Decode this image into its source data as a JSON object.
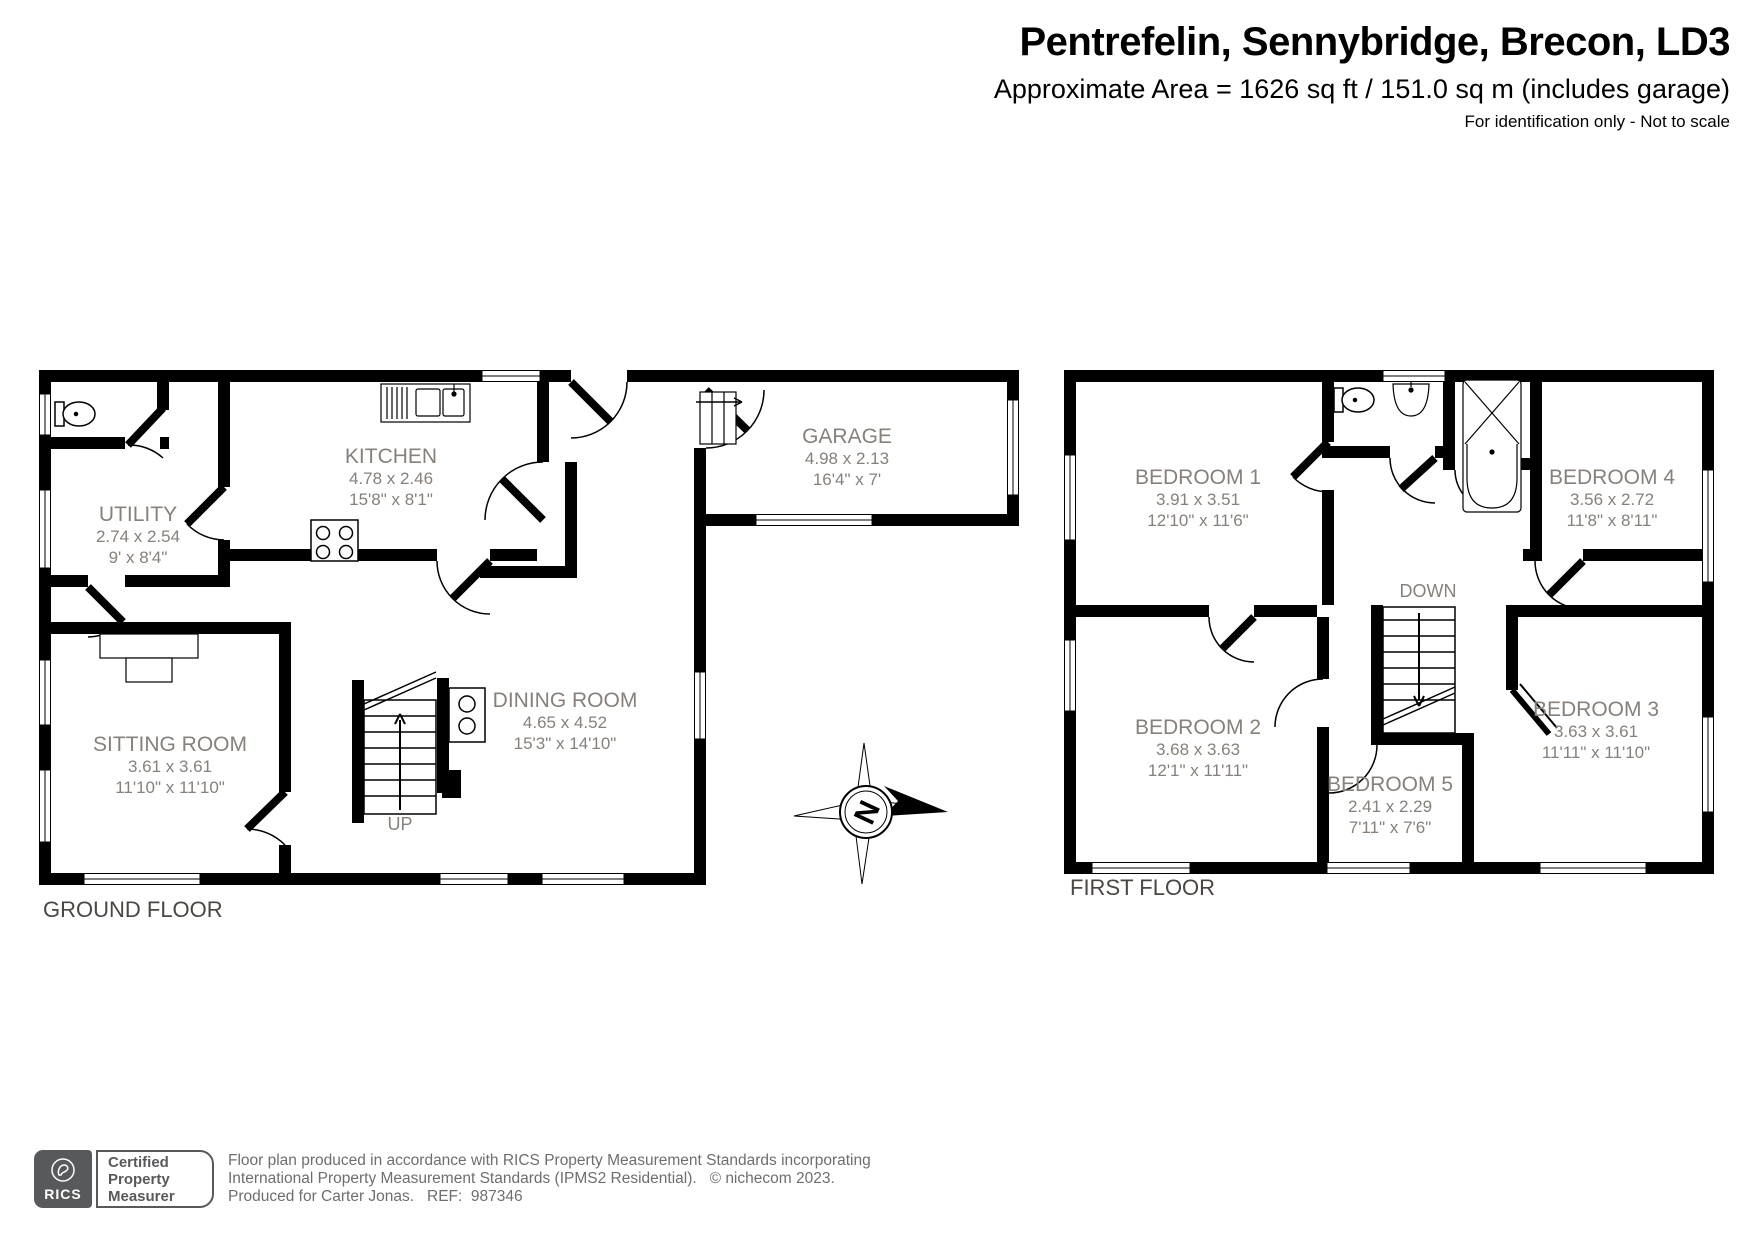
{
  "header": {
    "title": "Pentrefelin, Sennybridge, Brecon, LD3",
    "subtitle": "Approximate Area = 1626 sq ft / 151.0 sq m (includes garage)",
    "disclaimer": "For identification only - Not to scale"
  },
  "ground_floor": {
    "label": "GROUND FLOOR",
    "stair_label": "UP",
    "rooms": [
      {
        "name": "UTILITY",
        "metric": "2.74 x 2.54",
        "imperial": "9' x 8'4\""
      },
      {
        "name": "KITCHEN",
        "metric": "4.78 x 2.46",
        "imperial": "15'8\" x 8'1\""
      },
      {
        "name": "GARAGE",
        "metric": "4.98 x 2.13",
        "imperial": "16'4\" x 7'"
      },
      {
        "name": "SITTING ROOM",
        "metric": "3.61 x 3.61",
        "imperial": "11'10\" x 11'10\""
      },
      {
        "name": "DINING ROOM",
        "metric": "4.65 x 4.52",
        "imperial": "15'3\" x 14'10\""
      }
    ]
  },
  "first_floor": {
    "label": "FIRST FLOOR",
    "stair_label": "DOWN",
    "rooms": [
      {
        "name": "BEDROOM 1",
        "metric": "3.91 x 3.51",
        "imperial": "12'10\" x 11'6\""
      },
      {
        "name": "BEDROOM 4",
        "metric": "3.56 x 2.72",
        "imperial": "11'8\" x 8'11\""
      },
      {
        "name": "BEDROOM 2",
        "metric": "3.68 x 3.63",
        "imperial": "12'1\" x 11'11\""
      },
      {
        "name": "BEDROOM 5",
        "metric": "2.41 x 2.29",
        "imperial": "7'11\" x 7'6\""
      },
      {
        "name": "BEDROOM 3",
        "metric": "3.63 x 3.61",
        "imperial": "11'11\" x 11'10\""
      }
    ]
  },
  "compass": {
    "north_label": "N"
  },
  "footer": {
    "rics_label": "RICS",
    "badge": {
      "line1": "Certified",
      "line2": "Property",
      "line3": "Measurer"
    },
    "line1": "Floor plan produced in accordance with RICS Property Measurement Standards incorporating",
    "line2": "International Property Measurement Standards (IPMS2 Residential).   © nichecom 2023.",
    "line3": "Produced for Carter Jonas.   REF:  987346"
  },
  "colors": {
    "wall": "#000000",
    "room_text": "#87807B",
    "footer_text": "#6E6E6E",
    "brand_gray": "#58595B"
  }
}
